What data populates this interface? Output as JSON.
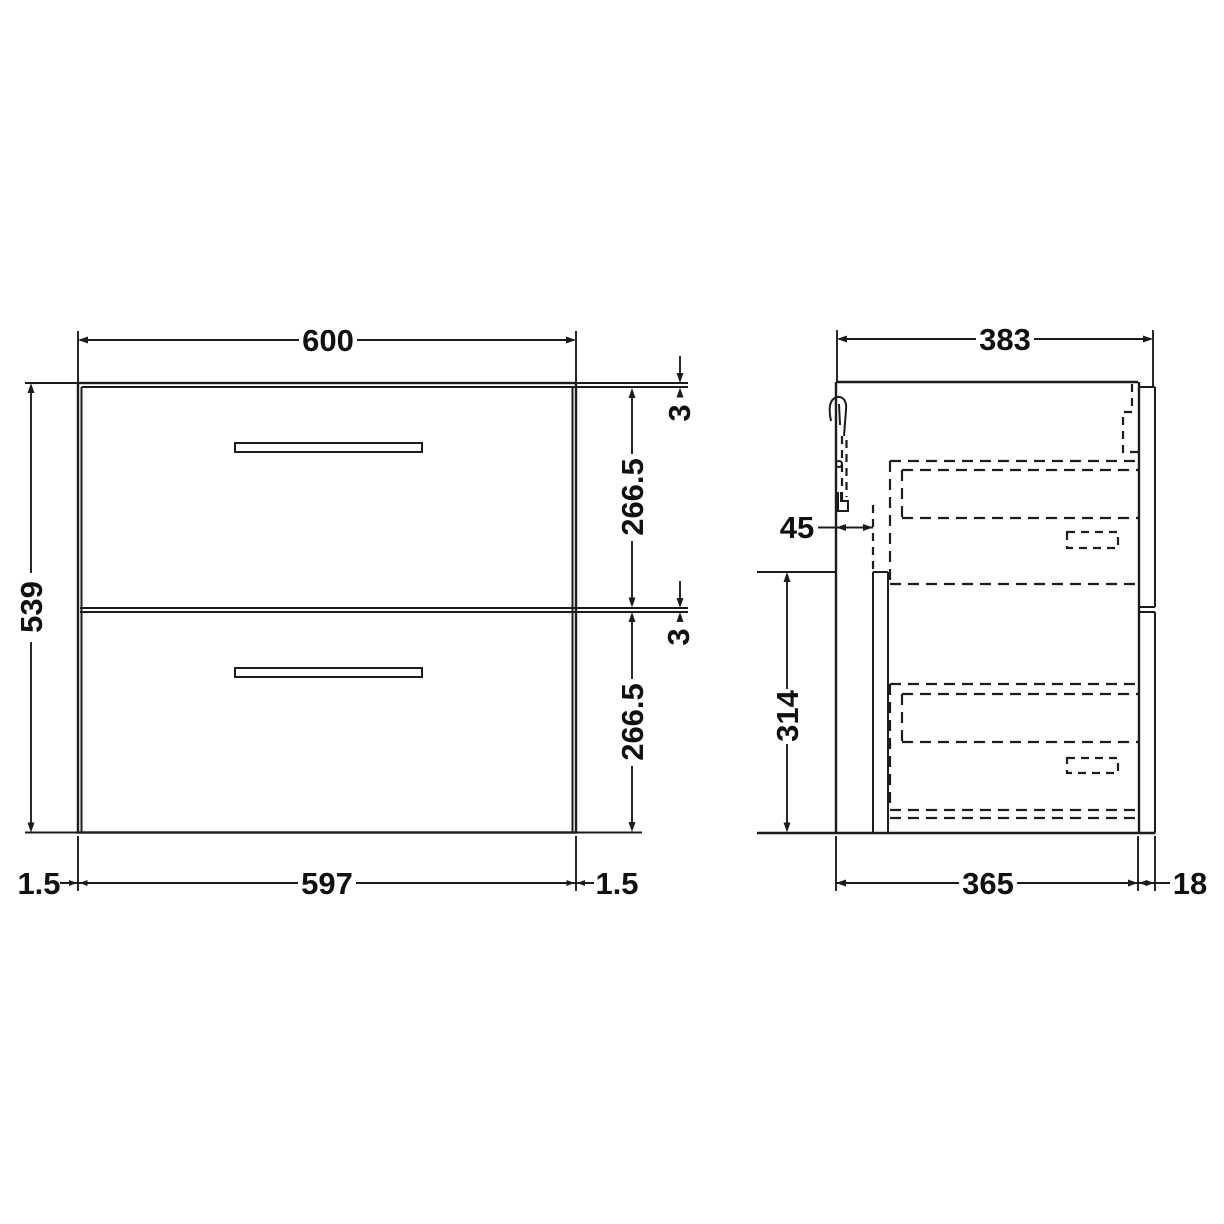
{
  "title": "Two-drawer wall-hung vanity unit - dimensioned technical drawing (front and side elevation)",
  "colors": {
    "line": "#1c1c1c",
    "text": "#111111",
    "background": "#ffffff"
  },
  "front_view": {
    "dim_width_top": "600",
    "dim_height_left": "539",
    "dim_top_gap": "3",
    "dim_upper_drawer": "266.5",
    "dim_mid_gap": "3",
    "dim_lower_drawer": "266.5",
    "dim_bottom_left_gap": "1.5",
    "dim_width_bottom": "597",
    "dim_bottom_right_gap": "1.5"
  },
  "side_view": {
    "dim_depth_top": "383",
    "dim_back_void": "45",
    "dim_back_panel_height": "314",
    "dim_depth_bottom": "365",
    "dim_front_thickness": "18"
  }
}
